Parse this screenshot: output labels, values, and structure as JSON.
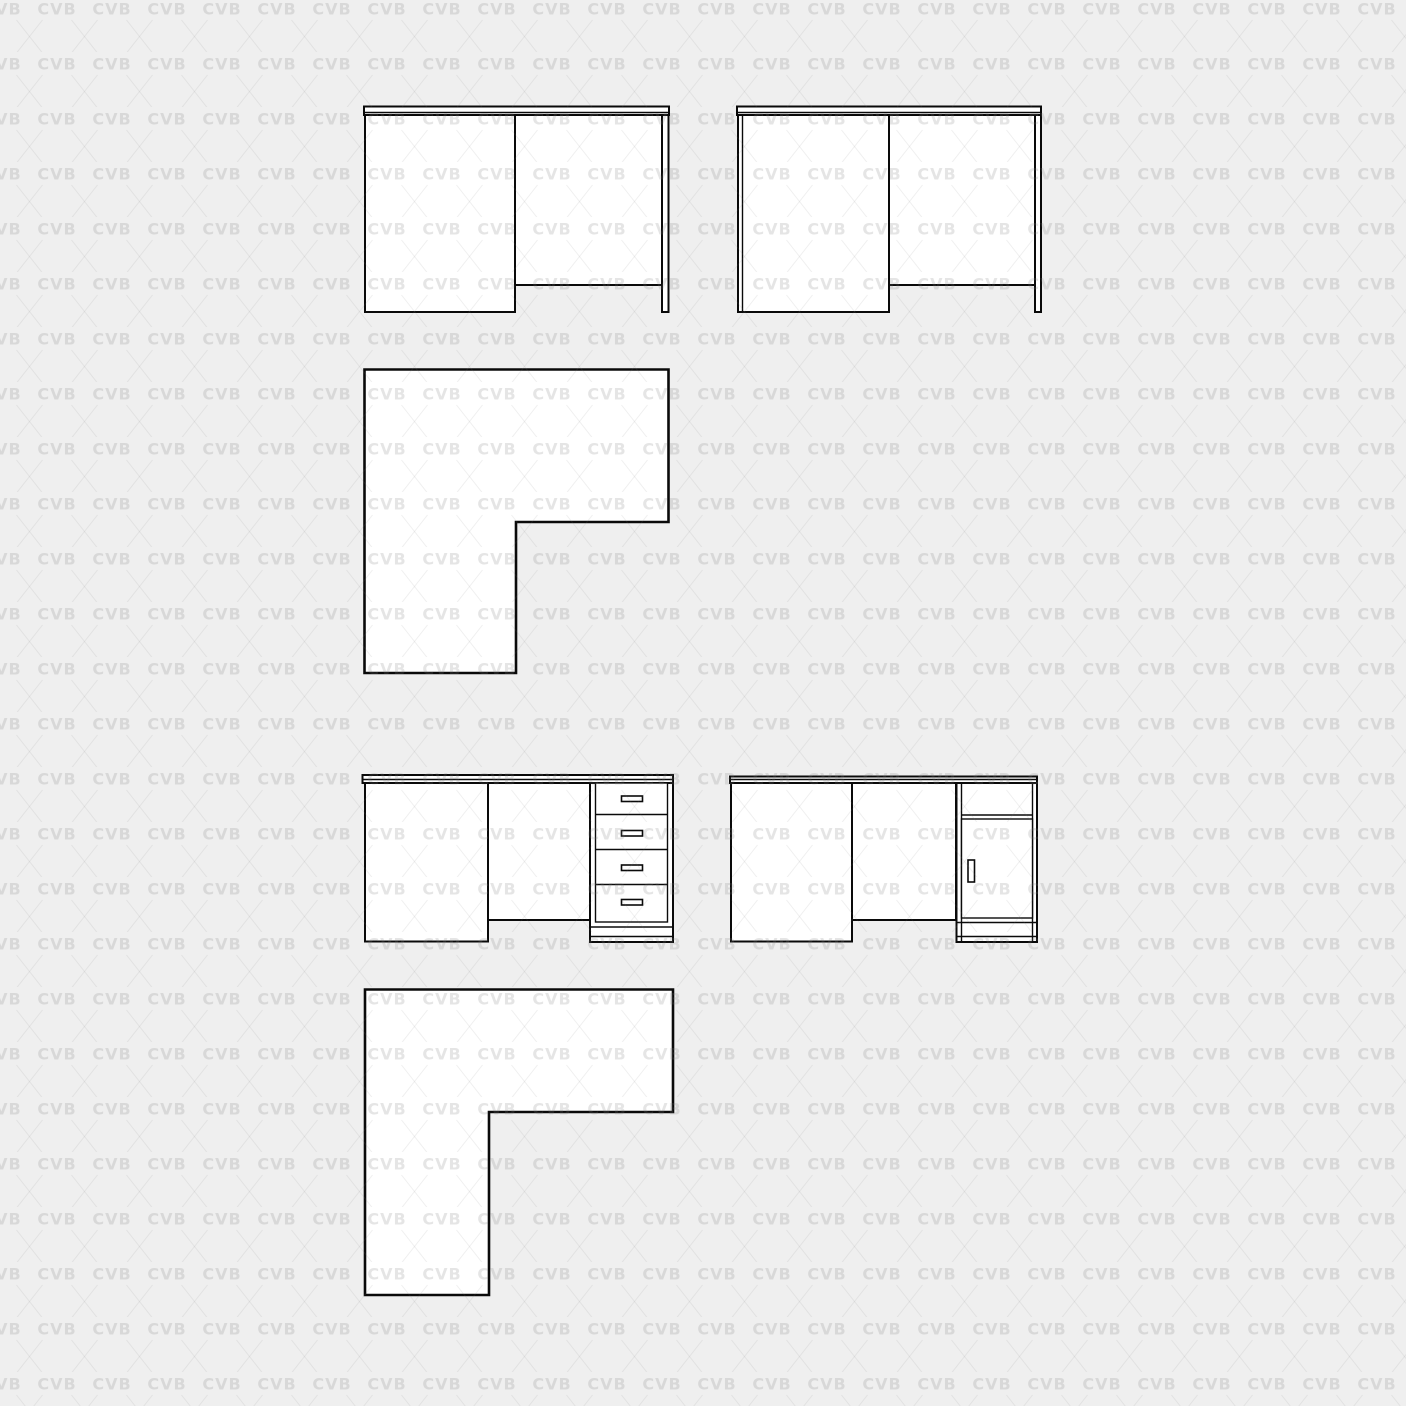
{
  "watermark": {
    "text": "CVB",
    "text_color": "rgba(124,124,124,0.20)",
    "cross_color": "rgba(124,124,124,0.12)"
  },
  "palette": {
    "background": "#efefef",
    "shape_fill": "#ffffff",
    "outline": "#0a0a0a"
  }
}
